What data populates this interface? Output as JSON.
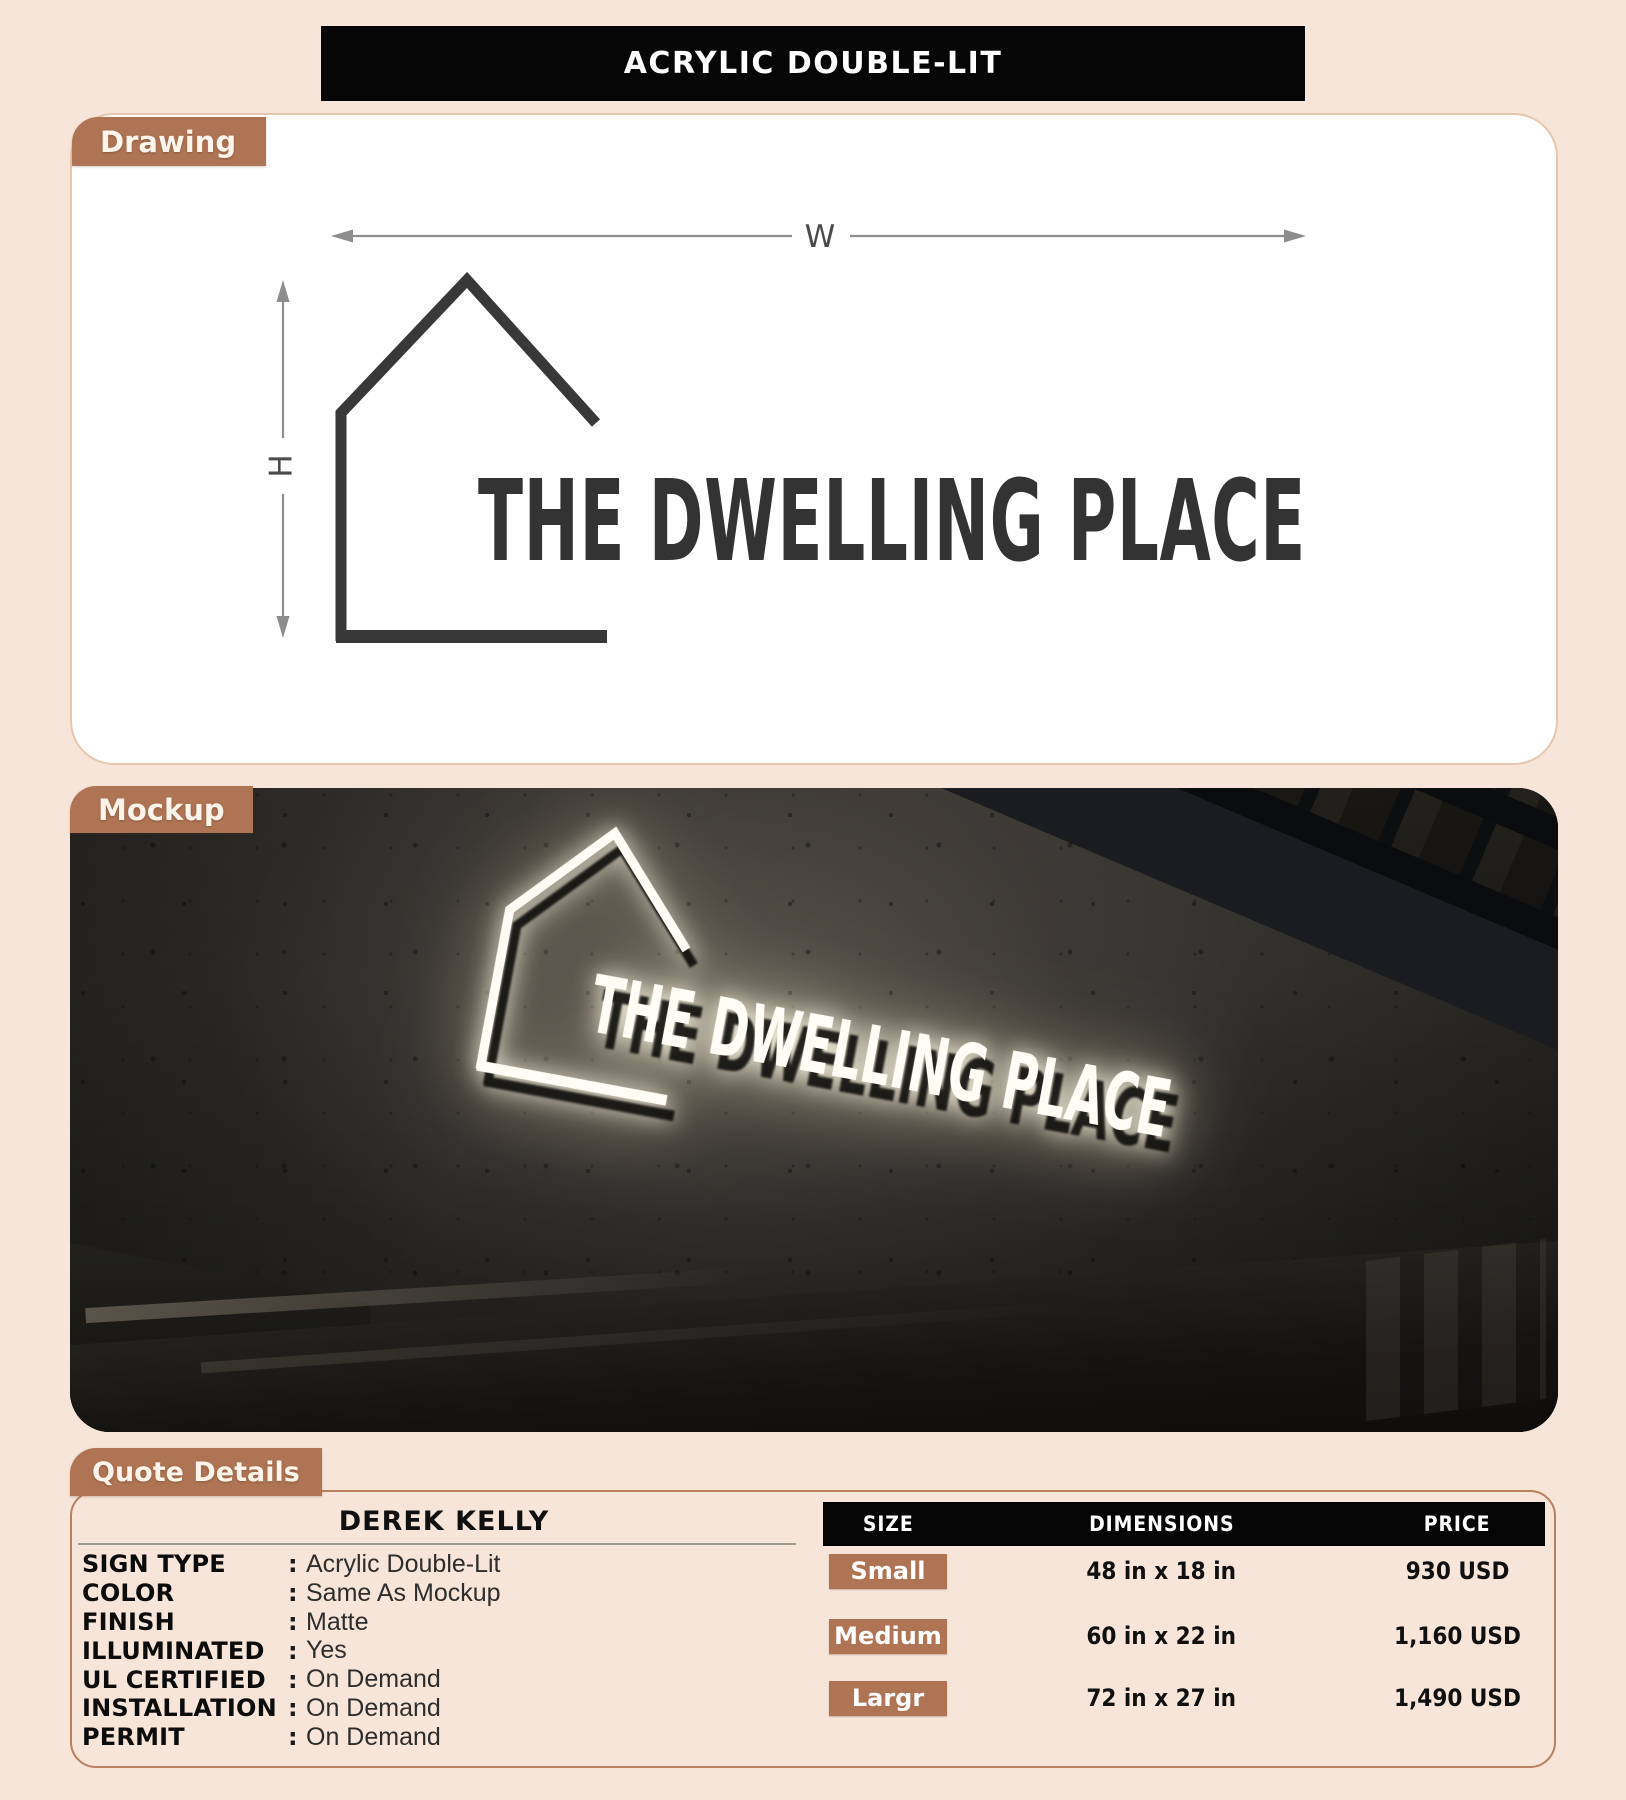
{
  "title": "ACRYLIC DOUBLE-LIT",
  "sections": {
    "drawing": "Drawing",
    "mockup": "Mockup",
    "quote": "Quote Details"
  },
  "drawing": {
    "width_label": "W",
    "height_label": "H",
    "logo_text": "THE DWELLING PLACE"
  },
  "mockup": {
    "logo_text": "THE DWELLING PLACE"
  },
  "quote": {
    "customer": "DEREK KELLY",
    "colon": ":",
    "details": [
      {
        "label": "SIGN TYPE",
        "value": "Acrylic Double-Lit"
      },
      {
        "label": "COLOR",
        "value": "Same As Mockup"
      },
      {
        "label": "FINISH",
        "value": "Matte"
      },
      {
        "label": "ILLUMINATED",
        "value": "Yes"
      },
      {
        "label": "UL CERTIFIED",
        "value": "On Demand"
      },
      {
        "label": "INSTALLATION",
        "value": "On Demand"
      },
      {
        "label": "PERMIT",
        "value": "On Demand"
      }
    ],
    "table": {
      "headers": [
        "SIZE",
        "DIMENSIONS",
        "PRICE"
      ],
      "rows": [
        {
          "size": "Small",
          "dimensions": "48 in x 18 in",
          "price": "930 USD"
        },
        {
          "size": "Medium",
          "dimensions": "60 in x 22 in",
          "price": "1,160 USD"
        },
        {
          "size": "Largr",
          "dimensions": "72 in x 27 in",
          "price": "1,490 USD"
        }
      ]
    }
  },
  "colors": {
    "background": "#f7e5d9",
    "accent_brown": "#ae7454",
    "bar_black": "#060606",
    "panel_white": "#ffffff",
    "drawing_ink": "#383838",
    "dimension_gray": "#8d8d8d"
  }
}
